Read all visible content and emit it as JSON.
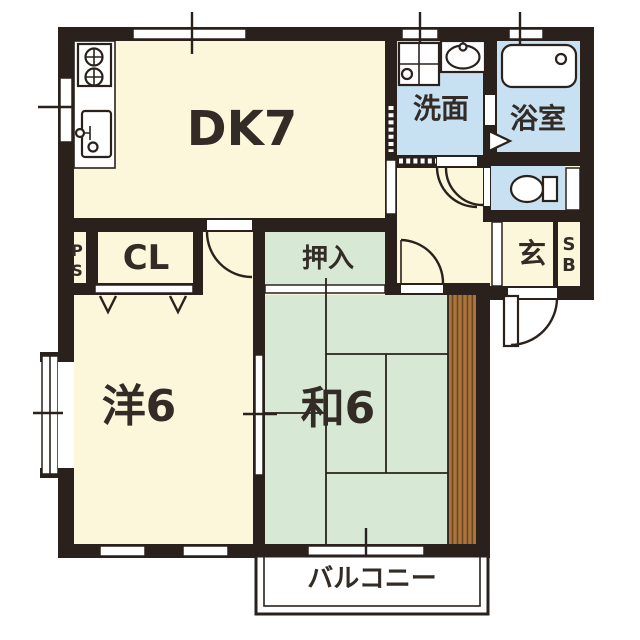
{
  "figure": {
    "type": "apartment-floor-plan"
  },
  "rooms": {
    "dining_kitchen": {
      "label": "DK7"
    },
    "washroom": {
      "label": "洗面"
    },
    "bathroom": {
      "label": "浴室"
    },
    "closet": {
      "label": "CL"
    },
    "oshiire": {
      "label": "押入"
    },
    "entrance": {
      "label": "玄"
    },
    "shoe_box": {
      "chars": [
        "S",
        "B"
      ]
    },
    "pipe_shaft": {
      "chars": [
        "P",
        "S"
      ]
    },
    "western_room": {
      "label": "洋6"
    },
    "japanese_room": {
      "label": "和6"
    },
    "balcony": {
      "label": "バルコニー"
    }
  },
  "colors": {
    "wall": "#2a211d",
    "cream": "#fcf7da",
    "blue": "#c7e1f3",
    "green": "#d7e8d5",
    "brown": "#aa743d",
    "stripe": "#6e4522",
    "ink": "#322b26",
    "paper": "#ffffff"
  }
}
